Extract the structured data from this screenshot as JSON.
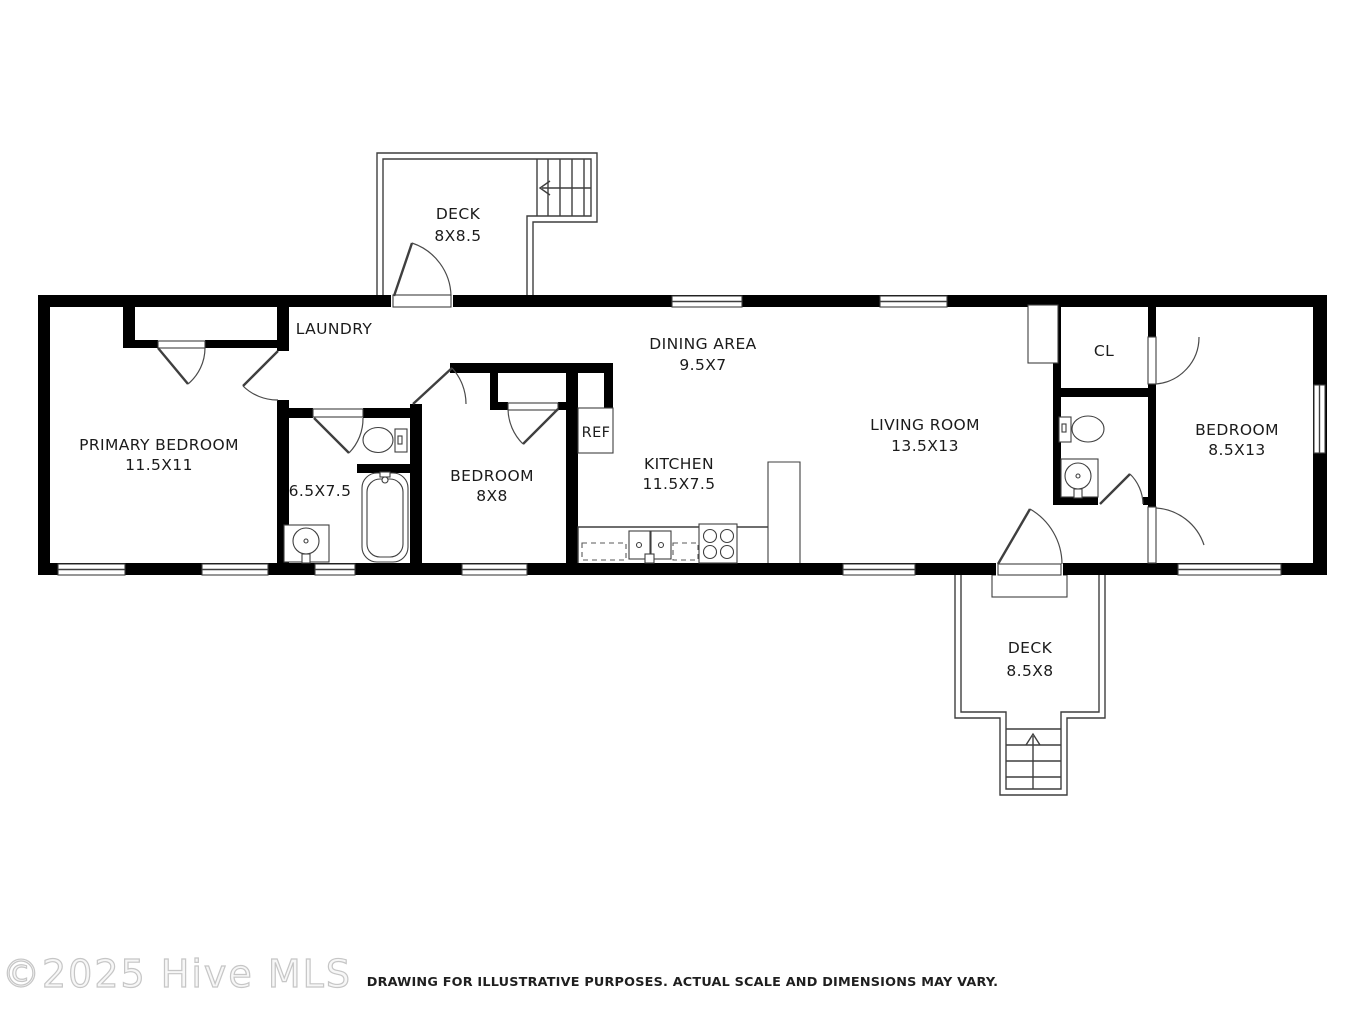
{
  "watermark": {
    "text": "©2025 Hive MLS"
  },
  "footer": {
    "disclaimer": "DRAWING FOR ILLUSTRATIVE PURPOSES. ACTUAL SCALE AND DIMENSIONS MAY VARY."
  },
  "floorplan": {
    "rooms": [
      {
        "name": "primary-bedroom",
        "label": "PRIMARY BEDROOM",
        "dims": "11.5X11"
      },
      {
        "name": "laundry",
        "label": "LAUNDRY",
        "dims": ""
      },
      {
        "name": "bathroom-1",
        "label": "",
        "dims": "6.5X7.5"
      },
      {
        "name": "bedroom-middle",
        "label": "BEDROOM",
        "dims": "8X8"
      },
      {
        "name": "kitchen",
        "label": "KITCHEN",
        "dims": "11.5X7.5"
      },
      {
        "name": "dining-area",
        "label": "DINING AREA",
        "dims": "9.5X7"
      },
      {
        "name": "living-room",
        "label": "LIVING ROOM",
        "dims": "13.5X13"
      },
      {
        "name": "closet",
        "label": "CL",
        "dims": ""
      },
      {
        "name": "bedroom-right",
        "label": "BEDROOM",
        "dims": "8.5X13"
      },
      {
        "name": "deck-top",
        "label": "DECK",
        "dims": "8X8.5"
      },
      {
        "name": "deck-bottom",
        "label": "DECK",
        "dims": "8.5X8"
      }
    ],
    "fixtures": {
      "fridge_label": "REF"
    },
    "colors": {
      "wall": "#000000",
      "line": "#3f3f3f",
      "background": "#ffffff"
    }
  }
}
